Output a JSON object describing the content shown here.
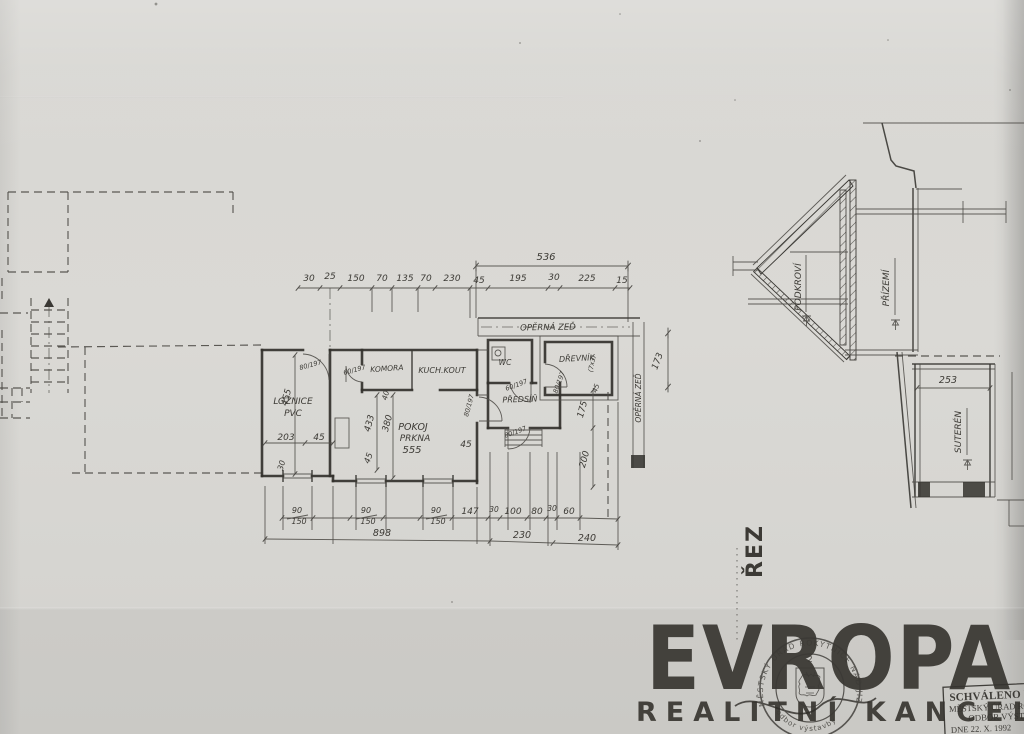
{
  "plan": {
    "dims_top_total": "536",
    "dims_top": [
      "30",
      "25",
      "150",
      "70",
      "135",
      "70",
      "230",
      "45",
      "195",
      "30",
      "225",
      "15"
    ],
    "windows": [
      {
        "num": "90",
        "den": "150"
      },
      {
        "num": "90",
        "den": "150"
      },
      {
        "num": "90",
        "den": "150"
      }
    ],
    "dims_bottom": [
      "147",
      "30",
      "100",
      "80",
      "30",
      "60"
    ],
    "totals": [
      "898",
      "230",
      "240"
    ],
    "dims_left": [
      "455",
      "203",
      "45",
      "30"
    ],
    "dims_mid": [
      "433",
      "380",
      "40",
      "45",
      "45"
    ],
    "dims_right": [
      "175",
      "200",
      "173",
      "45"
    ],
    "rooms": {
      "loznice1": "LOŽNICE",
      "loznice2": "PVC",
      "pokoj1": "POKOJ",
      "pokoj2": "PRKNA",
      "pokoj3": "555",
      "komora": "KOMORA",
      "kuchkout": "KUCH.KOUT",
      "wc": "WC",
      "drevnik": "DŘEVNÍK",
      "drevnik_note": "(7x3)",
      "predsin": "PŘEDSÍŇ"
    },
    "doors": [
      "80/197",
      "60/197",
      "80/197",
      "60/197",
      "80/197",
      "80/197"
    ],
    "retaining_wall_h": "OPĚRNÁ ZEĎ",
    "retaining_wall_v": "OPĚRNÁ ZEĎ"
  },
  "section": {
    "label": "ŘEZ",
    "podkrovi": "PODKROVÍ",
    "prizemi": "PŘÍZEMÍ",
    "suteren": "SUTERÉN",
    "dim": "253"
  },
  "branding": {
    "logo": "EVROPA",
    "subtitle": "REALITNÍ KANCELÁŘ",
    "watermark_color": "#eae8e2"
  },
  "stamps": {
    "round": {
      "number": "2",
      "arc_top": "MĚSTSKÝ ÚŘAD ROKYTNICE NAD JIZEROU",
      "arc_bottom": "odbor výstavby"
    },
    "box": {
      "line1": "SCHVÁLENO ROZHODNUTÍM",
      "line2": "MĚSTSKÝ ÚŘAD ROKYTNICE N.JIZ.",
      "line3": "ODBOR VÝSTAVBY",
      "line4": "DNE 22. X. 1992"
    }
  },
  "colors": {
    "ink": "#34322e",
    "paper": "#d7d6d2"
  }
}
